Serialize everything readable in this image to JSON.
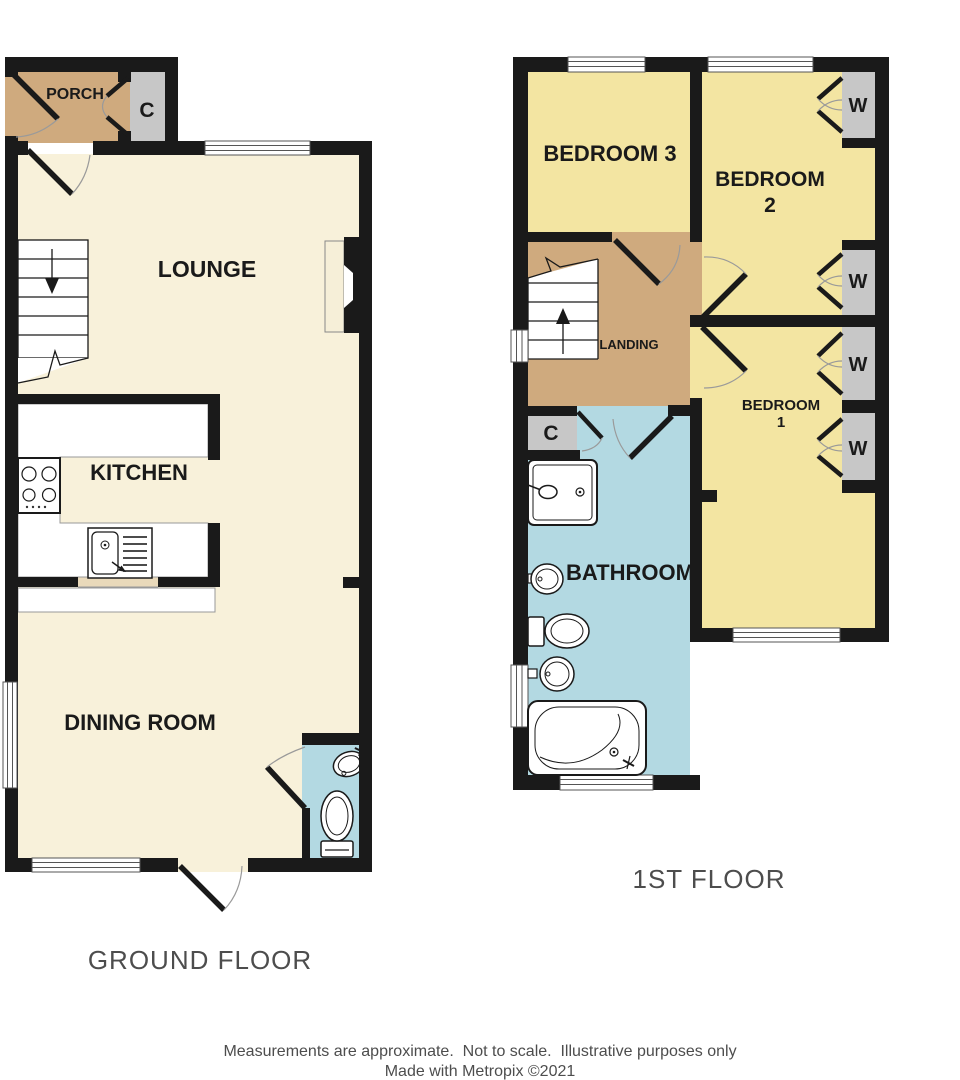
{
  "palette": {
    "wall": "#1a1a1a",
    "floor_cream": "#f8f1da",
    "porch_landing_tan": "#cfaa7e",
    "bedroom_yellow": "#f3e5a2",
    "bathroom_blue": "#b3d9e2",
    "closet_gray": "#c7c7c7",
    "window_stroke": "#555555",
    "floor_title_gray": "#4d4d4d"
  },
  "ground_floor": {
    "title": "GROUND FLOOR",
    "rooms": {
      "porch": "PORCH",
      "cupboard": "C",
      "lounge": "LOUNGE",
      "kitchen": "KITCHEN",
      "dining_room": "DINING ROOM"
    }
  },
  "first_floor": {
    "title": "1ST FLOOR",
    "rooms": {
      "bedroom3": "BEDROOM 3",
      "bedroom2_line1": "BEDROOM",
      "bedroom2_line2": "2",
      "bedroom1_line1": "BEDROOM",
      "bedroom1_line2": "1",
      "landing": "LANDING",
      "bathroom": "BATHROOM",
      "cupboard": "C",
      "wardrobe": "W"
    }
  },
  "footer": {
    "disclaimer": "Measurements are approximate.  Not to scale.  Illustrative purposes only",
    "credit": "Made with Metropix ©2021"
  }
}
